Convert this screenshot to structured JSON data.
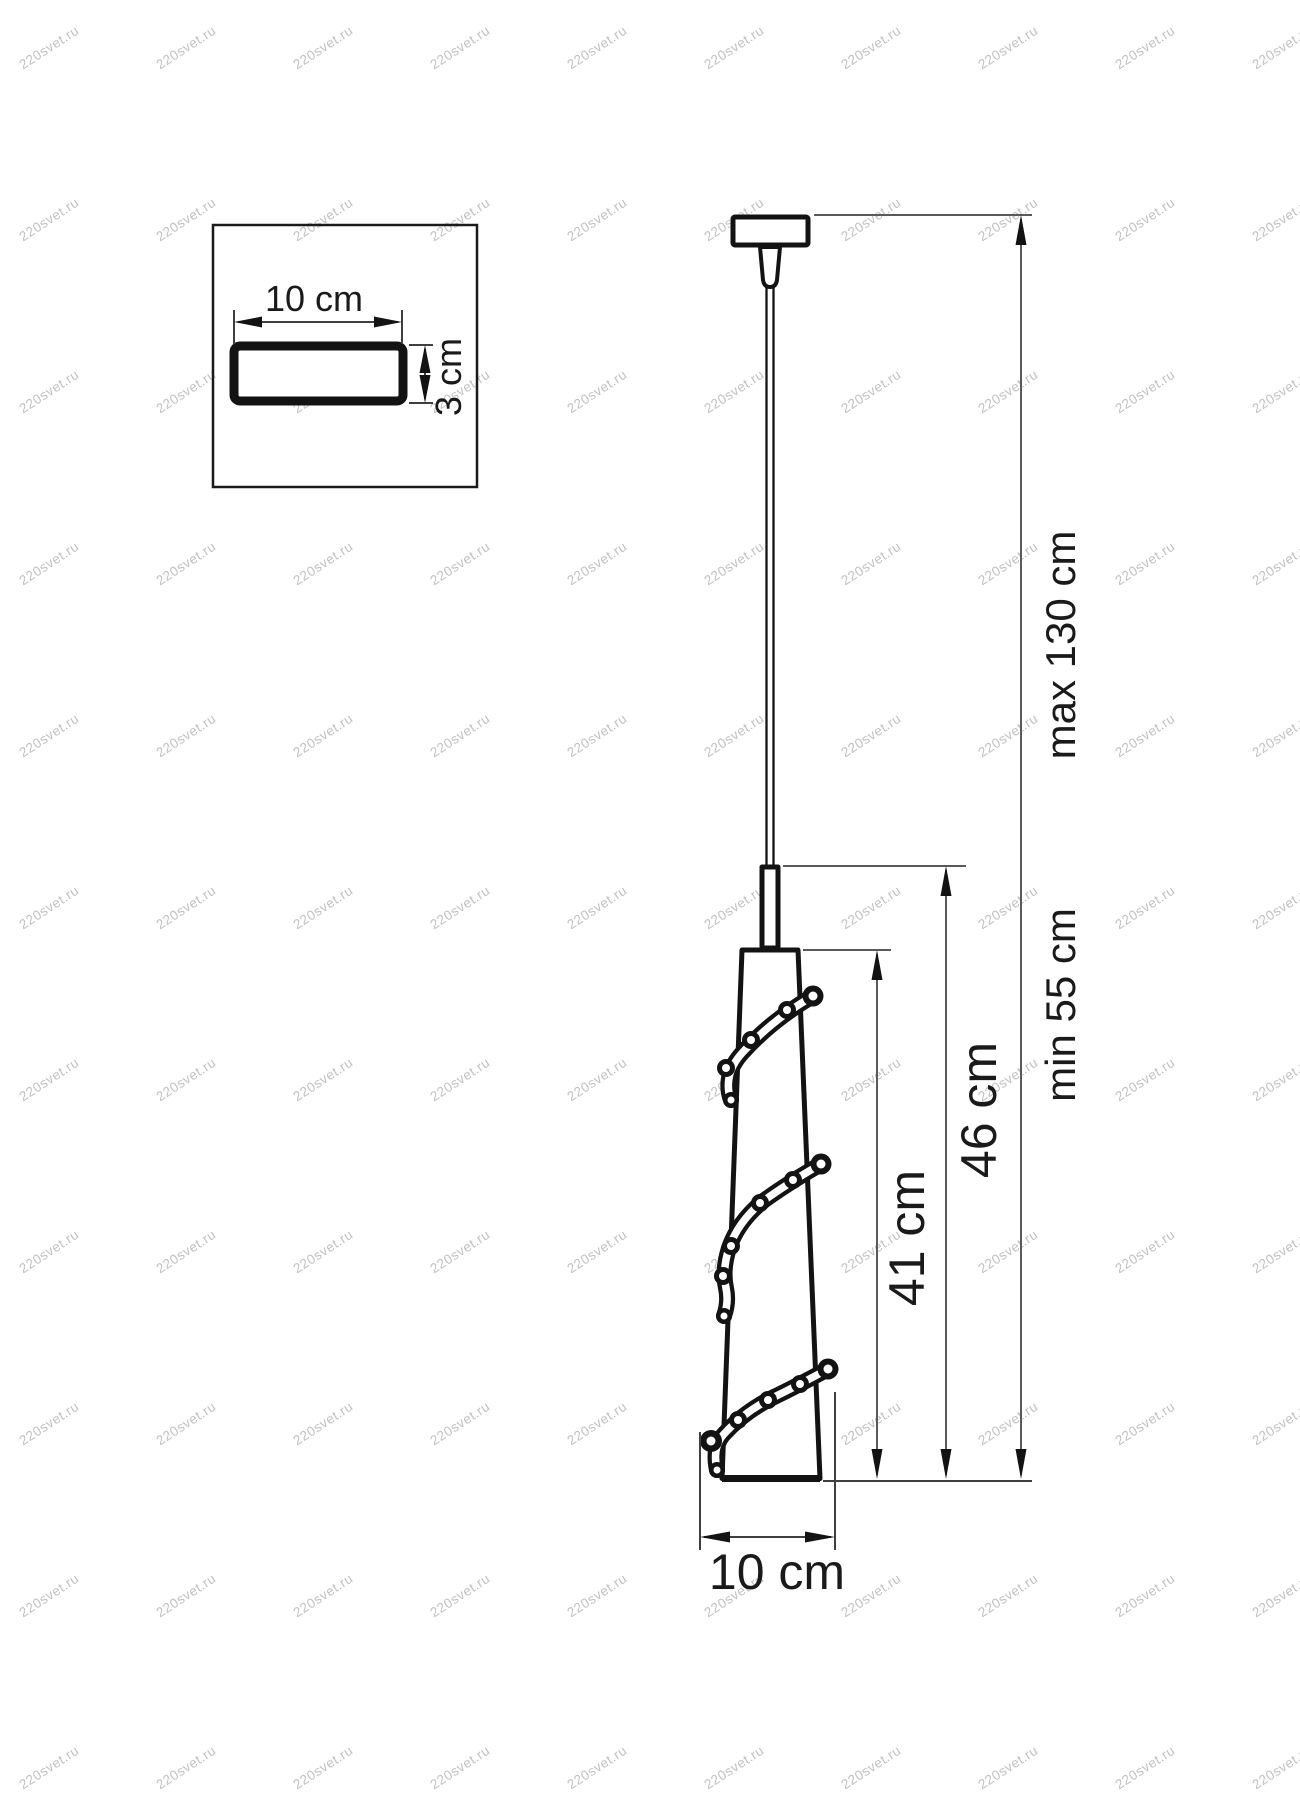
{
  "watermark": {
    "text": "220svet.ru"
  },
  "inset": {
    "width_label": "10 cm",
    "depth_label": "3 cm"
  },
  "dimensions": {
    "shade_height": "41 cm",
    "body_height": "46 cm",
    "suspension_min": "min 55 cm",
    "suspension_max": "max 130 cm",
    "shade_diameter": "10 cm"
  },
  "colors": {
    "background": "#ffffff",
    "outline": "#131313",
    "dimension_line": "#5a5a5a",
    "watermark": "#c1c1c1"
  }
}
